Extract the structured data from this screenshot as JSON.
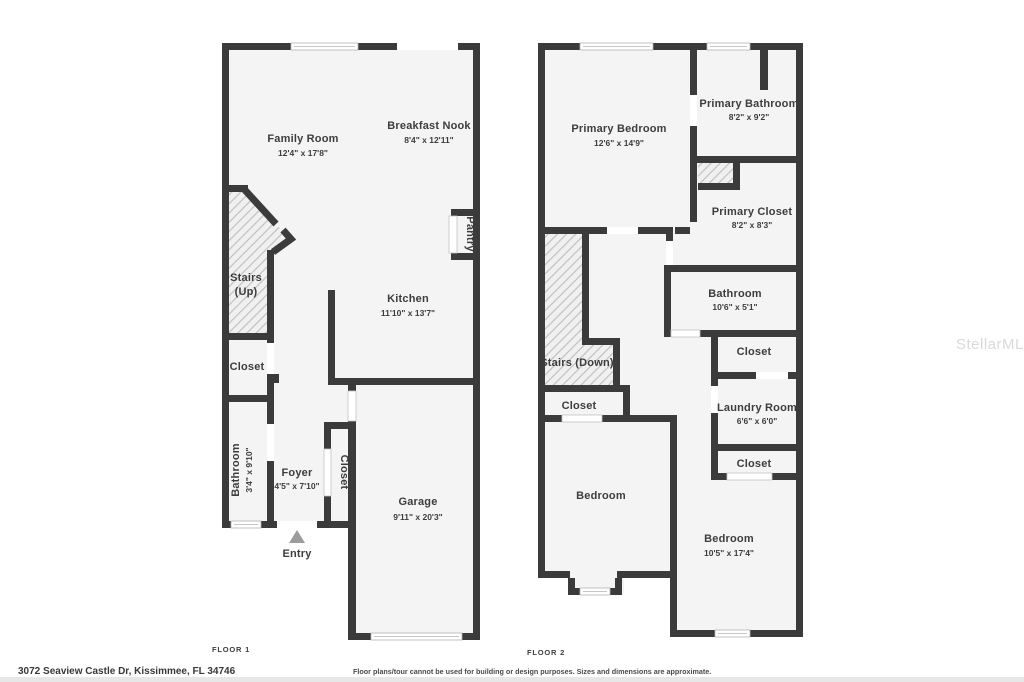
{
  "address": "3072 Seaview Castle Dr, Kissimmee, FL 34746",
  "disclaimer": "Floor plans/tour cannot be used for building or design purposes. Sizes and dimensions are approximate.",
  "watermark": "StellarMLS",
  "colors": {
    "wall": "#3b3b3b",
    "floor_fill": "#f4f4f4",
    "label_text": "#3d3d3d",
    "hatch_line": "#bdbdbd",
    "entry_marker": "#9c9c9c",
    "watermark_text": "#d9d9d9",
    "footer_strip": "#e7e7e7"
  },
  "floor1": {
    "label": "FLOOR 1",
    "entry": "Entry",
    "rooms": {
      "family_room": {
        "name": "Family Room",
        "dims": "12'4\" x 17'8\""
      },
      "breakfast_nook": {
        "name": "Breakfast Nook",
        "dims": "8'4\" x 12'11\""
      },
      "stairs": {
        "name": "Stairs",
        "dims": "(Up)"
      },
      "closet": {
        "name": "Closet"
      },
      "bathroom": {
        "name": "Bathroom",
        "dims": "3'4\" x 9'10\""
      },
      "foyer": {
        "name": "Foyer",
        "dims": "4'5\" x 7'10\""
      },
      "closet_foyer": {
        "name": "Closet"
      },
      "kitchen": {
        "name": "Kitchen",
        "dims": "11'10\" x 13'7\""
      },
      "pantry": {
        "name": "Pantry"
      },
      "garage": {
        "name": "Garage",
        "dims": "9'11\" x 20'3\""
      }
    }
  },
  "floor2": {
    "label": "FLOOR 2",
    "rooms": {
      "primary_bedroom": {
        "name": "Primary Bedroom",
        "dims": "12'6\" x 14'9\""
      },
      "primary_bathroom": {
        "name": "Primary Bathroom",
        "dims": "8'2\" x 9'2\""
      },
      "primary_closet": {
        "name": "Primary Closet",
        "dims": "8'2\" x 8'3\""
      },
      "bathroom": {
        "name": "Bathroom",
        "dims": "10'6\" x 5'1\""
      },
      "closet_upper": {
        "name": "Closet"
      },
      "stairs": {
        "name": "Stairs (Down)"
      },
      "closet_mid": {
        "name": "Closet"
      },
      "laundry": {
        "name": "Laundry Room",
        "dims": "6'6\" x 6'0\""
      },
      "closet_lower": {
        "name": "Closet"
      },
      "bedroom_left": {
        "name": "Bedroom"
      },
      "bedroom_right": {
        "name": "Bedroom",
        "dims": "10'5\" x 17'4\""
      }
    }
  }
}
